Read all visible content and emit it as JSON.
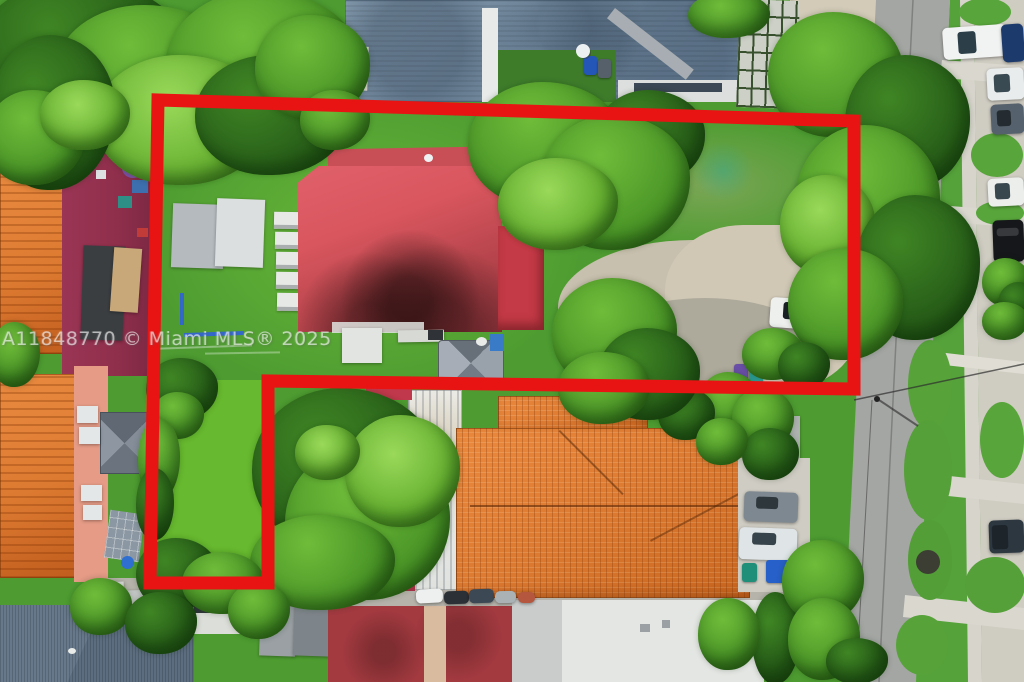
{
  "watermark": {
    "text": "A11848770 © Miami MLS® 2025"
  },
  "annotation": {
    "shape": "property-boundary-outline",
    "points": "158,100 854,121 854,389 268,381 268,583 150,583",
    "stroke_width": 13
  },
  "colors": {
    "boundary-red": "#e81414",
    "watermark-white": "rgba(255,255,255,0.58)",
    "grass": "#4e9c31",
    "lawn-bright": "#67b92f",
    "roof-main-red": "#d9565e",
    "roof-rear-red": "#c43a46",
    "roof-top-blue": "#8aa3b8",
    "roof-orange": "#dd7a31",
    "roof-maroon": "#a23a40",
    "roof-slate": "#5b6d7e",
    "roof-white": "#e9ebe8",
    "courtyard-maroon": "#8f2f4c",
    "asphalt": "#a4a6a3",
    "concrete": "#d6d4cb",
    "dirt": "#c9c1af"
  }
}
